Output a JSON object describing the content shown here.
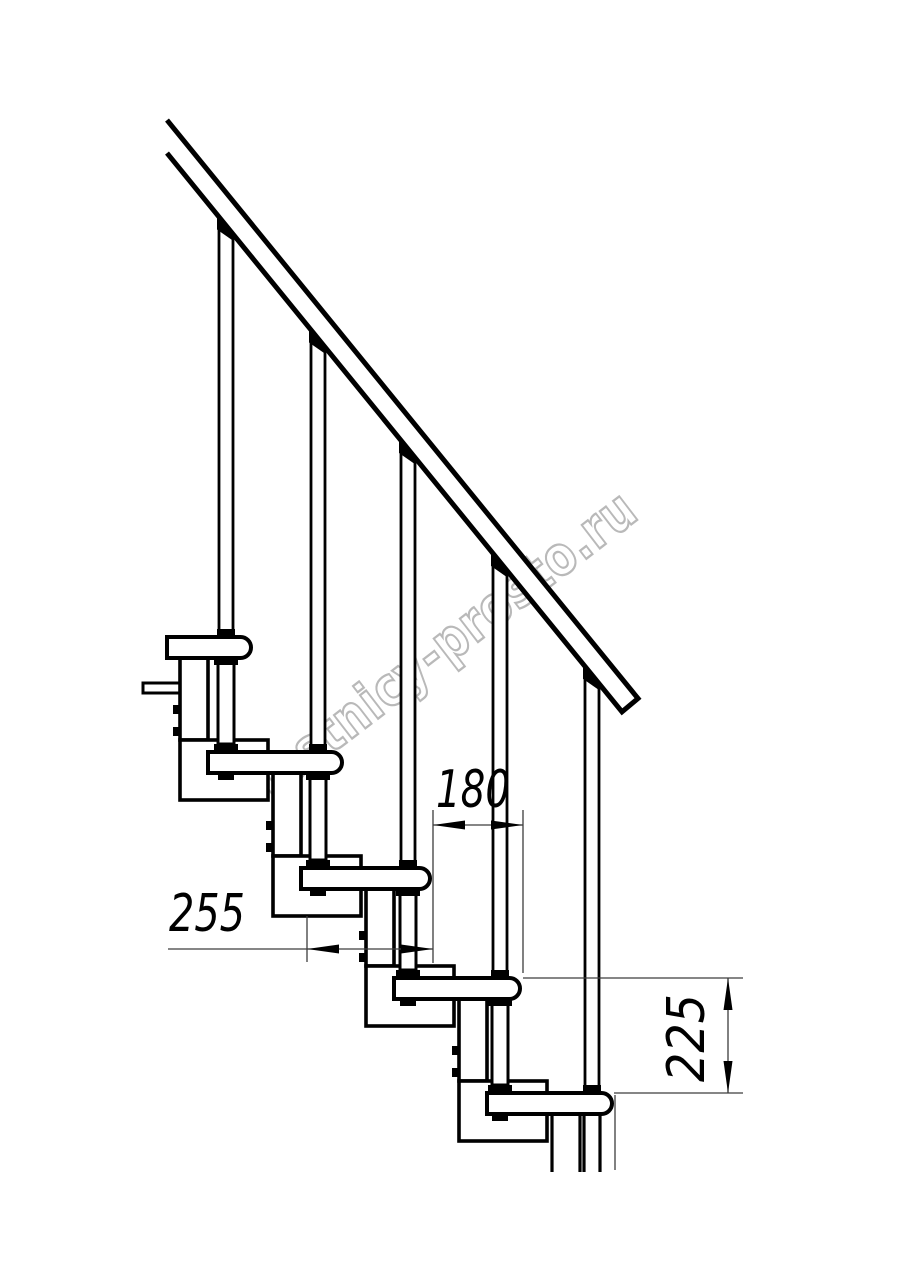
{
  "page": {
    "background": "#ffffff"
  },
  "watermark": {
    "text": "lestnicy-prosto.ru",
    "color": "#b9b9b9"
  },
  "drawing": {
    "subject": "modular-staircase-side-view",
    "line_color": "#000000",
    "thin_line_color": "#3d3d3d",
    "steps_visible": 5,
    "balusters_visible": 5,
    "handrail": true
  },
  "dimensions": [
    {
      "id": "dim-255",
      "label": "255",
      "orientation": "horizontal"
    },
    {
      "id": "dim-180",
      "label": "180",
      "orientation": "horizontal"
    },
    {
      "id": "dim-225",
      "label": "225",
      "orientation": "vertical"
    }
  ]
}
